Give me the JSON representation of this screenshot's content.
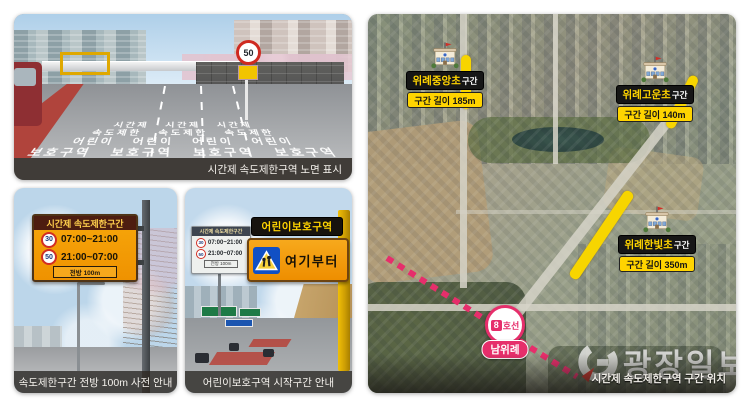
{
  "panel_road": {
    "caption": "시간제 속도제한구역 노면 표시",
    "pavement_lines": [
      "시간제   시간제   시간제",
      "속도제한   속도제한   속도제한",
      "어린이   어린이   어린이   어린이",
      "보호구역   보호구역   보호구역   보호구역"
    ],
    "speed_limit_sign": "50"
  },
  "panel_advance": {
    "caption": "속도제한구간 전방 100m 사전 안내",
    "sign_title": "시간제 속도제한구간",
    "rows": [
      {
        "limit": "30",
        "time": "07:00~21:00"
      },
      {
        "limit": "50",
        "time": "21:00~07:00"
      }
    ],
    "sign_footer": "전방 100m"
  },
  "panel_schoolzone": {
    "caption": "어린이보호구역 시작구간 안내",
    "small_sign_title": "시간제 속도제한구간",
    "small_rows": [
      {
        "limit": "30",
        "time": "07:00~21:00"
      },
      {
        "limit": "50",
        "time": "21:00~07:00"
      }
    ],
    "small_sign_footer": "전방 100m",
    "zone_title": "어린이보호구역",
    "zone_from": "여기부터"
  },
  "panel_map": {
    "caption": "시간제 속도제한구역 구간 위치",
    "watermark": "광장일보",
    "zones": [
      {
        "name": "위례중앙초",
        "suffix": "구간",
        "length": "구간 길이 185m"
      },
      {
        "name": "위례고운초",
        "suffix": "구간",
        "length": "구간 길이 140m"
      },
      {
        "name": "위례한빛초",
        "suffix": "구간",
        "length": "구간 길이 350m"
      }
    ],
    "station": {
      "line_number": "8",
      "line_label": "호선",
      "name": "남위례"
    }
  },
  "colors": {
    "highlight_yellow": "#f7d500",
    "subway_pink": "#e62e6b",
    "label_yellow": "#ffd400",
    "sign_orange": "#f59a00",
    "caption_bar": "#302a24"
  }
}
